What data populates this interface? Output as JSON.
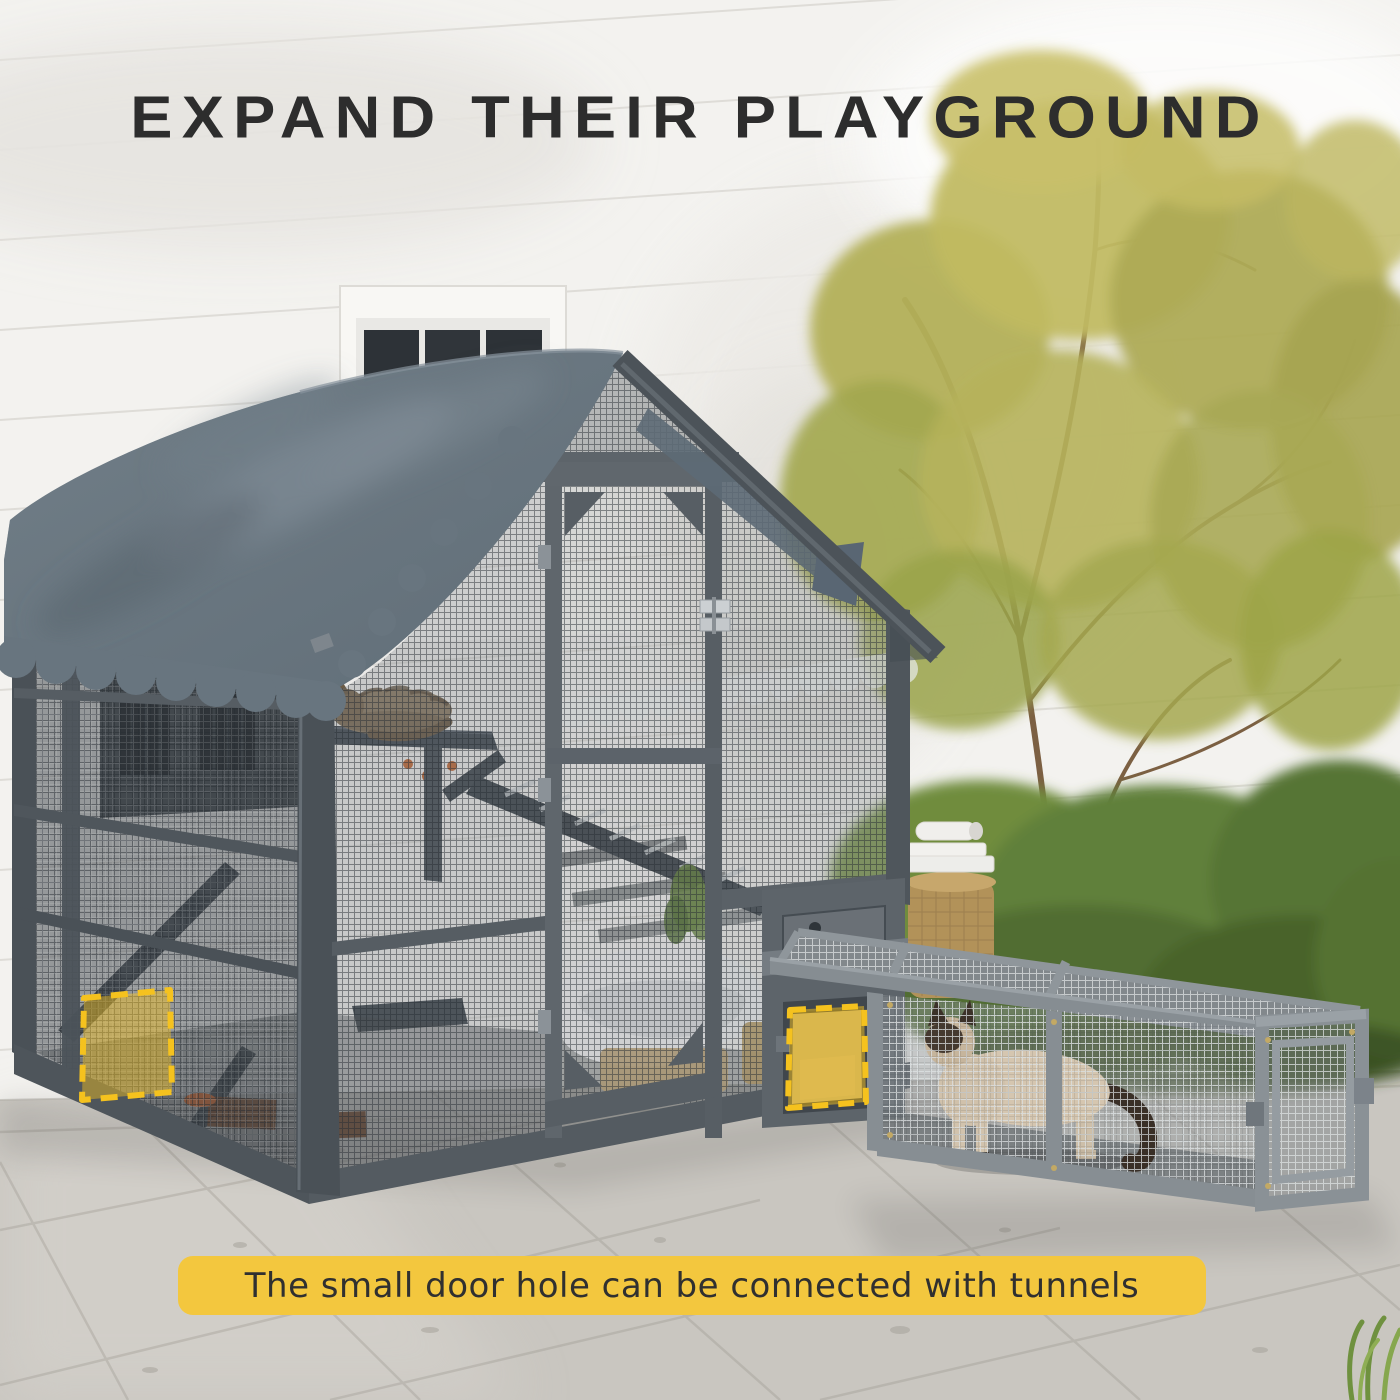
{
  "headline": {
    "text": "EXPAND THEIR PLAYGROUND"
  },
  "caption": {
    "text": "The small door hole can be connected with tunnels"
  },
  "colors": {
    "headline_dark": "#2D2D2D",
    "caption_text": "#303030",
    "banner_yellow": "#F3C73E",
    "accent_yellow": "#F5C21E",
    "roof_slate": "#68757F",
    "frame_gray": "#565D63",
    "frame_gray_dark": "#4C5359",
    "tunnel_frame": "#878E93",
    "wall_white": "#F3F2EF",
    "floor_gray": "#C9C6C0",
    "foliage_olive": "#B3B05A",
    "bush_green": "#5F7C34",
    "cat_cream": "#D5C6B0",
    "cat_mask_brown": "#463A2F",
    "tabby_brown": "#8D7C64"
  }
}
